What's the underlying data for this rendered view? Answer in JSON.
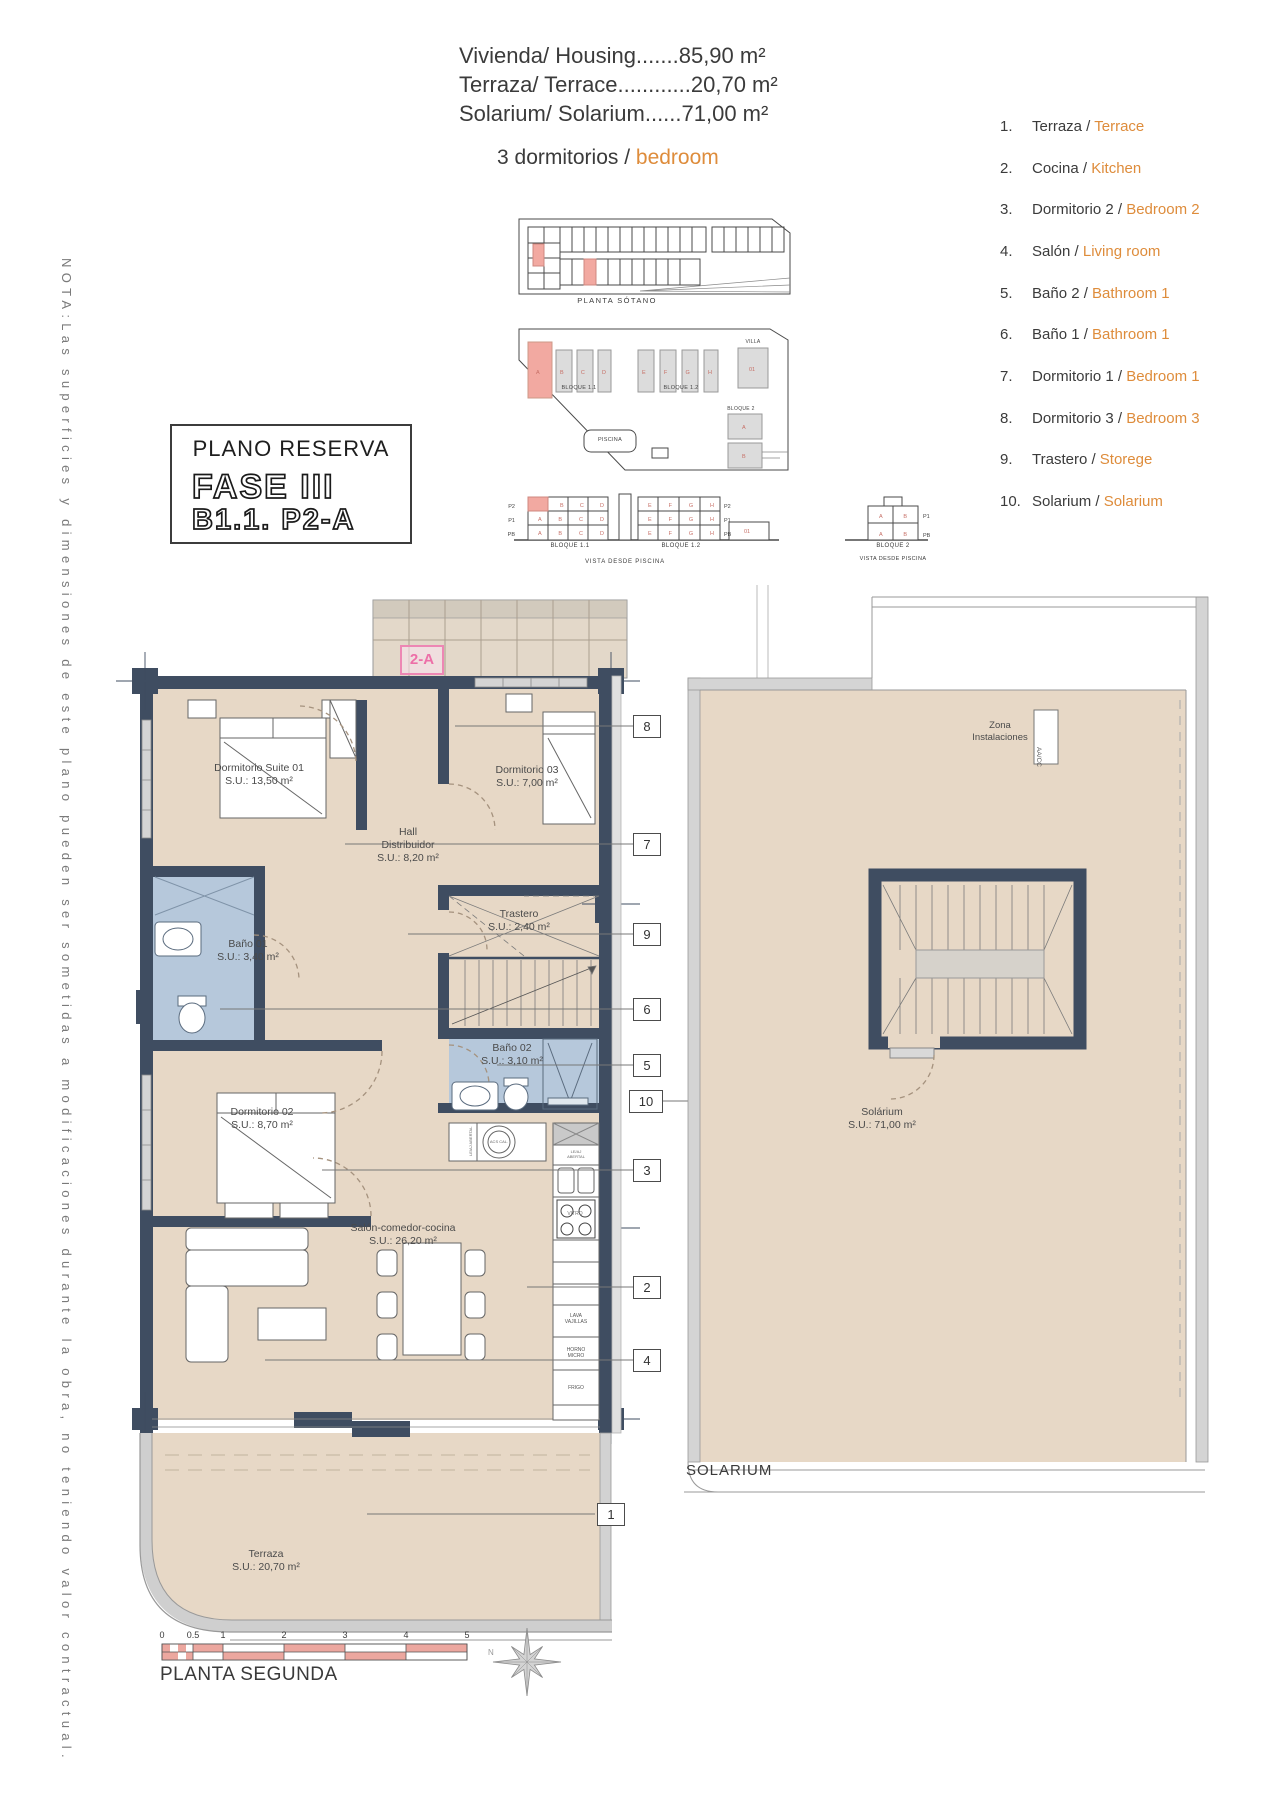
{
  "header": {
    "lines": [
      "Vivienda/ Housing.......85,90 m²",
      "Terraza/ Terrace............20,70 m²",
      "Solarium/ Solarium......71,00 m²"
    ],
    "subtitle_dark": "3 dormitorios / ",
    "subtitle_accent": "bedroom"
  },
  "reserve_box": {
    "title": "PLANO RESERVA",
    "phase": "FASE III",
    "unit": "B1.1. P2-A"
  },
  "note_vertical": "NOTA:Las superficies y dimensiones de este plano pueden ser sometidas a modificaciones durante la obra, no teniendo valor contractual.",
  "legend": {
    "items": [
      {
        "num": "1.",
        "es": "Terraza / ",
        "en": "Terrace"
      },
      {
        "num": "2.",
        "es": "Cocina / ",
        "en": "Kitchen"
      },
      {
        "num": "3.",
        "es": "Dormitorio 2 / ",
        "en": "Bedroom 2"
      },
      {
        "num": "4.",
        "es": "Salón / ",
        "en": "Living room"
      },
      {
        "num": "5.",
        "es": "Baño 2 / ",
        "en": "Bathroom 1"
      },
      {
        "num": "6.",
        "es": "Baño 1 / ",
        "en": "Bathroom 1"
      },
      {
        "num": "7.",
        "es": "Dormitorio 1 / ",
        "en": "Bedroom 1"
      },
      {
        "num": "8.",
        "es": "Dormitorio 3 / ",
        "en": "Bedroom 3"
      },
      {
        "num": "9.",
        "es": "Trastero / ",
        "en": "Storege"
      },
      {
        "num": "10.",
        "es": "Solarium / ",
        "en": "Solarium"
      }
    ]
  },
  "site": {
    "basement_caption": "PLANTA SÓTANO",
    "bloque11": "BLOQUE 1.1",
    "bloque12": "BLOQUE 1.2",
    "bloque2": "BLOQUE 2",
    "villa": "VILLA",
    "piscina": "PISCINA",
    "vista": "VISTA DESDE PISCINA",
    "floors": [
      "P2",
      "P1",
      "PB"
    ],
    "letters": {
      "bcd": "B C D",
      "abcd": "A B C D",
      "efgh": "E F G H",
      "ab": "A B",
      "d1": "01",
      "a": "A",
      "b": "B"
    }
  },
  "plan": {
    "unit_tag": "2-A",
    "rooms": {
      "suite": [
        "Dormitorio Suite 01",
        "S.U.: 13,50 m²"
      ],
      "dorm03": [
        "Dormitorio 03",
        "S.U.: 7,00 m²"
      ],
      "hall": [
        "Hall",
        "Distribuidor",
        "S.U.: 8,20 m²"
      ],
      "bano01": [
        "Baño 01",
        "S.U.: 3,40 m²"
      ],
      "trastero": [
        "Trastero",
        "S.U.: 2,40 m²"
      ],
      "bano02": [
        "Baño 02",
        "S.U.: 3,10 m²"
      ],
      "dorm02": [
        "Dormitorio 02",
        "S.U.: 8,70 m²"
      ],
      "salon": [
        "Salón-comedor-cocina",
        "S.U.: 26,20 m²"
      ],
      "terraza": [
        "Terraza",
        "S.U.: 20,70 m²"
      ],
      "solarium": [
        "Solárium",
        "S.U.: 71,00 m²"
      ],
      "zona": [
        "Zona",
        "Instalaciones"
      ]
    },
    "aacc": "AA/CC",
    "kitchen": {
      "vitro": "VITRO",
      "lava": [
        "LAVA",
        "VAJILLAS"
      ],
      "horno": [
        "HORNO",
        "MICRO"
      ],
      "frigo": "FRIGO",
      "acs": "ACS CAL.",
      "tiny": [
        "LE/AJ",
        "ABERTAL"
      ]
    },
    "callouts": [
      "1",
      "2",
      "3",
      "4",
      "5",
      "6",
      "7",
      "8",
      "9",
      "10"
    ],
    "scale_ticks": [
      "0",
      "0.5",
      "1",
      "2",
      "3",
      "4",
      "5"
    ],
    "compass_north": "N",
    "captions": {
      "plan": "PLANTA SEGUNDA",
      "solarium": "SOLARIUM"
    }
  },
  "colors": {
    "accent_orange": "#DE8C3B",
    "wall": "#3F4D61",
    "floor_beige": "#E7D8C6",
    "bath_blue": "#B6C8DB",
    "highlight_pink": "#F2A9A1",
    "unit_tag_pink": "#ED6FA8",
    "scale_red": "#ECA79F"
  }
}
